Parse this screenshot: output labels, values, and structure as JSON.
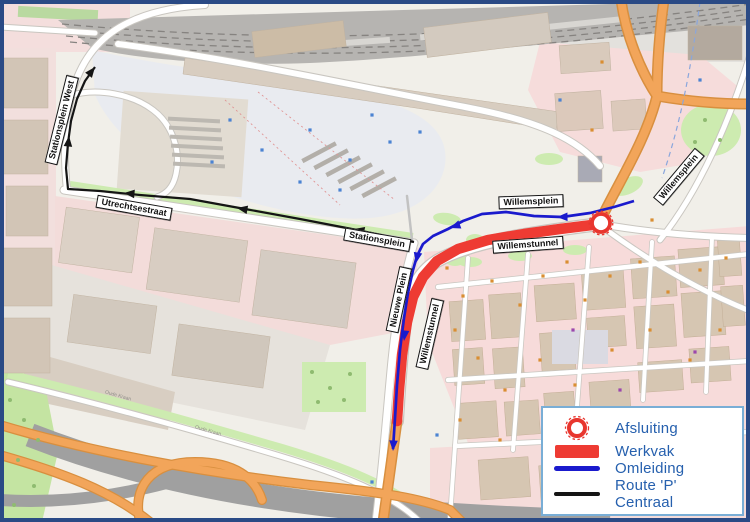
{
  "frame": {
    "border_color": "#2a4a85",
    "land_color": "#f1efe9"
  },
  "legend": {
    "text_color": "#2660ae",
    "border_color": "#79aed6",
    "items": [
      {
        "id": "afsluiting",
        "label": "Afsluiting",
        "symbol": "circle",
        "color": "#e8362e"
      },
      {
        "id": "werkvak",
        "label": "Werkvak",
        "symbol": "bar",
        "color": "#ee3b33"
      },
      {
        "id": "omleiding",
        "label": "Omleiding",
        "symbol": "line",
        "color": "#1a1acd"
      },
      {
        "id": "route_p",
        "label": "Route 'P' Centraal",
        "symbol": "line",
        "color": "#151515"
      }
    ]
  },
  "map": {
    "street_labels": [
      {
        "text": "Stationsplein West",
        "x": 62,
        "y": 120,
        "rot": -76
      },
      {
        "text": "Utrechtsestraat",
        "x": 134,
        "y": 208,
        "rot": 10
      },
      {
        "text": "Stationsplein",
        "x": 377,
        "y": 240,
        "rot": 10
      },
      {
        "text": "Willemsplein",
        "x": 531,
        "y": 202,
        "rot": -2
      },
      {
        "text": "Willemsplein",
        "x": 679,
        "y": 177,
        "rot": -50
      },
      {
        "text": "Willemstunnel",
        "x": 528,
        "y": 245,
        "rot": -4
      },
      {
        "text": "Nieuwe Plein",
        "x": 399,
        "y": 300,
        "rot": -78
      },
      {
        "text": "Willemstunnel",
        "x": 430,
        "y": 334,
        "rot": -77
      }
    ],
    "minor_labels": [
      {
        "text": "Oude Kraan",
        "x": 118,
        "y": 396,
        "rot": 16
      },
      {
        "text": "Oude Kraan",
        "x": 208,
        "y": 431,
        "rot": 16
      }
    ]
  },
  "overlays": {
    "afsluiting": {
      "cx": 601,
      "cy": 223,
      "r": 9,
      "color": "#e8362e"
    },
    "werkvak": {
      "color": "#ee3b33",
      "width": 10.5,
      "points": [
        [
          592,
          225
        ],
        [
          560,
          229
        ],
        [
          524,
          234
        ],
        [
          488,
          240
        ],
        [
          458,
          249
        ],
        [
          437,
          261
        ],
        [
          423,
          277
        ],
        [
          413,
          297
        ],
        [
          407,
          322
        ],
        [
          402,
          355
        ],
        [
          399,
          390
        ],
        [
          397,
          421
        ]
      ]
    },
    "omleiding": {
      "color": "#1a1acd",
      "width": 2.7,
      "points": [
        [
          634,
          201
        ],
        [
          614,
          207
        ],
        [
          590,
          213
        ],
        [
          562,
          217
        ],
        [
          534,
          216
        ],
        [
          506,
          212
        ],
        [
          482,
          214
        ],
        [
          463,
          221
        ],
        [
          448,
          229
        ],
        [
          433,
          236
        ],
        [
          423,
          244
        ],
        [
          417,
          256
        ],
        [
          413,
          270
        ],
        [
          408,
          293
        ],
        [
          404,
          318
        ],
        [
          400,
          350
        ],
        [
          397,
          385
        ],
        [
          395,
          418
        ],
        [
          393,
          449
        ]
      ],
      "arrows": [
        {
          "x": 557,
          "y": 217,
          "angle": 179
        },
        {
          "x": 450,
          "y": 228,
          "angle": 160
        },
        {
          "x": 416,
          "y": 263,
          "angle": 101
        },
        {
          "x": 404,
          "y": 341,
          "angle": 96
        },
        {
          "x": 393,
          "y": 451,
          "angle": 93
        }
      ]
    },
    "route_p": {
      "color": "#151515",
      "width": 2.2,
      "points": [
        [
          414,
          242
        ],
        [
          386,
          236
        ],
        [
          352,
          229
        ],
        [
          300,
          219
        ],
        [
          245,
          209
        ],
        [
          190,
          199
        ],
        [
          140,
          195
        ],
        [
          100,
          191
        ],
        [
          68,
          189
        ],
        [
          66,
          168
        ],
        [
          68,
          143
        ],
        [
          71,
          121
        ],
        [
          77,
          99
        ],
        [
          85,
          81
        ],
        [
          95,
          67
        ]
      ],
      "arrows": [
        {
          "x": 354,
          "y": 229,
          "angle": 192
        },
        {
          "x": 237,
          "y": 208,
          "angle": 190
        },
        {
          "x": 124,
          "y": 193,
          "angle": 185
        },
        {
          "x": 69,
          "y": 136,
          "angle": 276
        },
        {
          "x": 95,
          "y": 67,
          "angle": 308
        }
      ]
    }
  },
  "poi": {
    "colors": {
      "o": "#d98e32",
      "b": "#4b83d2",
      "p": "#9c47ad"
    },
    "dots": [
      [
        447,
        268,
        "o"
      ],
      [
        463,
        296,
        "o"
      ],
      [
        492,
        281,
        "o"
      ],
      [
        520,
        305,
        "o"
      ],
      [
        543,
        276,
        "o"
      ],
      [
        567,
        262,
        "o"
      ],
      [
        585,
        300,
        "o"
      ],
      [
        610,
        276,
        "o"
      ],
      [
        640,
        262,
        "o"
      ],
      [
        668,
        292,
        "o"
      ],
      [
        700,
        270,
        "o"
      ],
      [
        726,
        258,
        "o"
      ],
      [
        455,
        330,
        "o"
      ],
      [
        478,
        358,
        "o"
      ],
      [
        505,
        390,
        "o"
      ],
      [
        540,
        360,
        "o"
      ],
      [
        575,
        385,
        "o"
      ],
      [
        612,
        350,
        "o"
      ],
      [
        650,
        330,
        "o"
      ],
      [
        690,
        360,
        "o"
      ],
      [
        720,
        330,
        "o"
      ],
      [
        460,
        420,
        "o"
      ],
      [
        500,
        440,
        "o"
      ],
      [
        640,
        420,
        "o"
      ],
      [
        573,
        330,
        "p"
      ],
      [
        695,
        352,
        "p"
      ],
      [
        620,
        390,
        "p"
      ],
      [
        230,
        120,
        "b"
      ],
      [
        262,
        150,
        "b"
      ],
      [
        310,
        130,
        "b"
      ],
      [
        350,
        160,
        "b"
      ],
      [
        390,
        142,
        "b"
      ],
      [
        300,
        182,
        "b"
      ],
      [
        340,
        190,
        "b"
      ],
      [
        212,
        162,
        "b"
      ],
      [
        372,
        115,
        "b"
      ],
      [
        420,
        132,
        "b"
      ],
      [
        450,
        255,
        "b"
      ],
      [
        437,
        435,
        "b"
      ],
      [
        372,
        482,
        "b"
      ],
      [
        560,
        100,
        "b"
      ],
      [
        592,
        130,
        "o"
      ],
      [
        602,
        62,
        "o"
      ],
      [
        700,
        80,
        "b"
      ],
      [
        540,
        205,
        "b"
      ],
      [
        652,
        220,
        "o"
      ]
    ]
  }
}
